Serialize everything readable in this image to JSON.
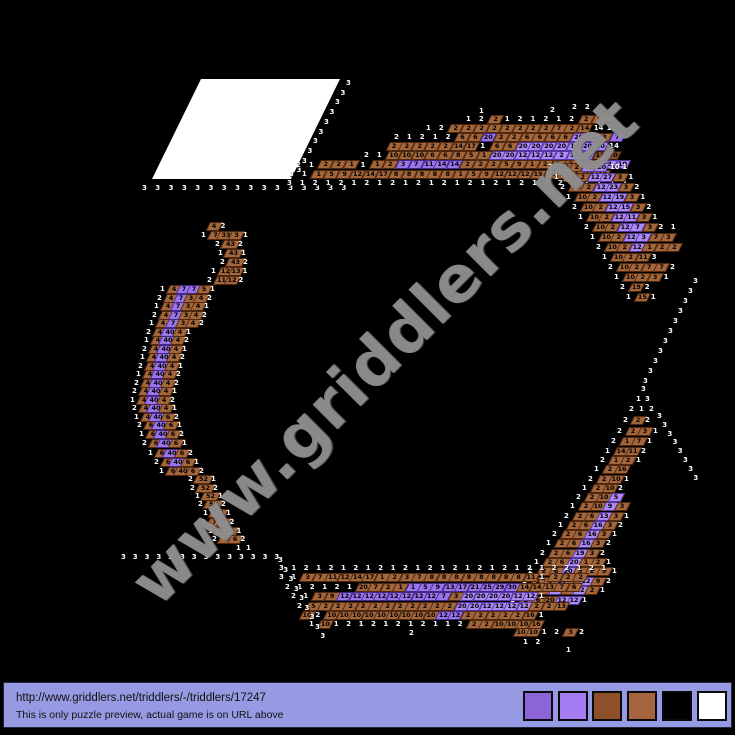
{
  "watermark": {
    "text": "www.griddlers.net",
    "color": "#949494"
  },
  "solved_region": {
    "x": 201,
    "y": 79,
    "w": 139,
    "h": 100
  },
  "footer": {
    "bg": "#969ae2",
    "url": "http://www.griddlers.net/triddlers/-/triddlers/17247",
    "note": "This is only puzzle preview, actual game is on URL above",
    "palette": [
      "#8b64d8",
      "#a57cf2",
      "#8e4f2b",
      "#a5663f",
      "#000000",
      "#ffffff"
    ],
    "palette_left": 519,
    "palette_step": 34.7
  },
  "puzzle": {
    "cell": {
      "w": 13,
      "h": 8.6
    },
    "colors": {
      "b": {
        "bg": "#a3663b",
        "bd": "#50280f"
      },
      "d": {
        "bg": "#8a4f28",
        "bd": "#3a1e08"
      },
      "p": {
        "bg": "#9a75ea",
        "bd": "#45278c"
      },
      "l": {
        "bg": "#ab89f4",
        "bd": "#5636a0"
      }
    },
    "wide_values": [
      "33",
      "40",
      "43",
      "52"
    ],
    "runs": [
      {
        "x": 146,
        "y": 188,
        "dx": 13.3,
        "cells": "w3 w3 w3 w3 w3 w3 w3 w3 w3 w3 w3 w3 w3 w3 w3 w3"
      },
      {
        "x": 350,
        "y": 83,
        "dx": -5.5,
        "dy": 9.7,
        "cells": "w3 w3 w3 w3 w3 w3 w3 w3 w3 w3"
      },
      {
        "x": 291,
        "y": 183,
        "dx": 12.9,
        "cells": "w3 w1 w2 w1 w2 w1 w2 w1 w2 w1 w2 w1 w2 w1 w2 w1 w2 w1 w2 w1 w2 w2 w1 w2 w1 w2 w1"
      },
      {
        "x": 293,
        "y": 174,
        "dx": 12.9,
        "cells": "w3 w1 b1 b5 b9 b12 b14 b17 b8 b8 b8 b8 b8 b1 b5 b9 b12 b12 b12 b15 b16 b16 b1 b10 b10"
      },
      {
        "x": 300,
        "y": 164.5,
        "dx": 12.9,
        "cells": "w2 w1 b2 b2 b1 w1 b1 b2 p3 p7 p11 p14 p14 b2 b2 b2 b5 b9 b1 b2 b2 b2 b10 b2 l2 l10"
      },
      {
        "x": 368,
        "y": 155,
        "dx": 12.9,
        "cells": "w2 w1 b10 b10 b10 b6 b6 b8 b5 b1 l20 l20 l12 l12 l12 l2 l12 l12 d12 d30"
      },
      {
        "x": 394,
        "y": 146,
        "dx": 12.9,
        "cells": "b2 b2 b2 b2 b2 b14 b17 w1 b6 b6 l20 l20 l20 l20 l12 l20 l20 w14"
      },
      {
        "x": 398,
        "y": 137,
        "dx": 12.9,
        "cells": "w2 w1 w2 w1 w2 b6 b6 p20 b2 b2 b6 b6 b6 b6 l20 l13 b3 p7"
      },
      {
        "x": 430,
        "y": 128,
        "dx": 12.9,
        "cells": "w1 w2 b2 b2 b2 b2 b2 b2 b2 b2 b7 b2 b14 w14 w1"
      },
      {
        "x": 470,
        "y": 119,
        "dx": 12.9,
        "cells": "w1 w2 b2 w1 w2 w1 w2 w1 w2 b2 b1 w2"
      },
      {
        "x": 483,
        "y": 111,
        "cells": "w1"
      },
      {
        "x": 554,
        "y": 110,
        "cells": "w2"
      },
      {
        "x": 576,
        "y": 107,
        "dx": 12.9,
        "cells": "w2 w2"
      },
      {
        "x": 552,
        "y": 167,
        "dx": 12.4,
        "cells": "w2 b10 b2 l12 l20 w10 w1"
      },
      {
        "x": 558,
        "y": 177,
        "dx": 12.4,
        "cells": "w1 b10 b2 l12 l27 b3 w1"
      },
      {
        "x": 564,
        "y": 187,
        "dx": 12.4,
        "cells": "w2 b10 b2 l12 l23 b3 w2"
      },
      {
        "x": 570,
        "y": 197,
        "dx": 12.4,
        "cells": "w1 b10 b2 l12 l19 b3 w1"
      },
      {
        "x": 576,
        "y": 207,
        "dx": 12.4,
        "cells": "w2 b10 b2 l12 l15 b3 w2"
      },
      {
        "x": 582,
        "y": 217,
        "dx": 12.4,
        "cells": "w1 b10 b2 l12 l11 b3 w1"
      },
      {
        "x": 588,
        "y": 227,
        "dx": 12.4,
        "cells": "w2 b10 b2 l12 l7 b3 w2 w1"
      },
      {
        "x": 594,
        "y": 237,
        "dx": 12.4,
        "cells": "w1 b10 b2 l12 l3 b7 b3"
      },
      {
        "x": 600,
        "y": 247,
        "dx": 12.4,
        "cells": "w2 b10 b2 l12 b1 b2 b2"
      },
      {
        "x": 606,
        "y": 257,
        "dx": 12.4,
        "cells": "w1 b10 b2 b11 w3"
      },
      {
        "x": 612,
        "y": 267,
        "dx": 12.4,
        "cells": "w2 b10 b2 b7 b7 w2"
      },
      {
        "x": 618,
        "y": 277,
        "dx": 12.4,
        "cells": "w1 b10 b2 b3 w1"
      },
      {
        "x": 624,
        "y": 287,
        "dx": 12.4,
        "cells": "w2 b19 w2"
      },
      {
        "x": 630,
        "y": 297,
        "dx": 12.4,
        "cells": "w1 b15 w1"
      },
      {
        "x": 697,
        "y": 281,
        "dx": -5,
        "dy": 10,
        "cells": "w3 w3 w3 w3 w3 w3 w3 w3 w3 w3 w3"
      },
      {
        "x": 661,
        "y": 416,
        "dx": 5.2,
        "dy": 8.8,
        "cells": "w3 w3 w3 w3 w3 w3 w3 w3"
      },
      {
        "x": 645,
        "y": 389,
        "cells": "w3"
      },
      {
        "x": 640,
        "y": 399,
        "dx": 9,
        "cells": "w1 w3"
      },
      {
        "x": 633,
        "y": 409,
        "dx": 10,
        "cells": "w2 w1 w2"
      },
      {
        "x": 627,
        "y": 420,
        "dx": 11,
        "cells": "w2 b2 w2"
      },
      {
        "x": 621,
        "y": 431,
        "dx": 12,
        "cells": "w2 b2 b3 w1"
      },
      {
        "x": 615,
        "y": 441,
        "dx": 12,
        "cells": "w2 b1 b7 w1"
      },
      {
        "x": 609,
        "y": 451,
        "dx": 12,
        "cells": "w1 b14 b11 w2"
      },
      {
        "x": 604,
        "y": 460,
        "dx": 12,
        "cells": "w2 b1 b2 w1"
      },
      {
        "x": 598,
        "y": 469,
        "dx": 12,
        "cells": "w1 b2 b16"
      },
      {
        "x": 592,
        "y": 479,
        "dx": 12,
        "cells": "w2 b2 b10 w1"
      },
      {
        "x": 586,
        "y": 488,
        "dx": 12,
        "cells": "w1 b2 b10 w2"
      },
      {
        "x": 580,
        "y": 497,
        "dx": 12,
        "cells": "w2 b2 b10 l5"
      },
      {
        "x": 574,
        "y": 506,
        "dx": 12,
        "cells": "w1 b2 b10 l9 b3"
      },
      {
        "x": 568,
        "y": 516,
        "dx": 12,
        "cells": "w2 b2 b6 l13 b3 w1"
      },
      {
        "x": 562,
        "y": 525,
        "dx": 12,
        "cells": "w1 b2 b6 l16 b3 w2"
      },
      {
        "x": 556,
        "y": 534,
        "dx": 12,
        "cells": "w2 b2 b6 l16 b3 w1"
      },
      {
        "x": 550,
        "y": 543,
        "dx": 12,
        "cells": "w1 b2 b6 l16 b3 w2"
      },
      {
        "x": 544,
        "y": 553,
        "dx": 12,
        "cells": "w2 b2 b6 l19 b3 w2"
      },
      {
        "x": 538,
        "y": 562,
        "dx": 12,
        "cells": "w1 b2 b6 l20 b1 b2 w1"
      },
      {
        "x": 532,
        "y": 571,
        "dx": 12,
        "cells": "w2 b2 b6 l20 b3 b2 b5 w1"
      },
      {
        "x": 526,
        "y": 581,
        "dx": 12,
        "cells": "w1 b2 b6 l20 b7 l12 b9 w2"
      },
      {
        "x": 520,
        "y": 590,
        "dx": 12,
        "cells": "w2 b2 b6 l20 b11 l12 b2 w1"
      },
      {
        "x": 514,
        "y": 600,
        "dx": 12,
        "cells": "w1 b2 b6 b20 l12 l12 w1"
      },
      {
        "x": 283,
        "y": 568,
        "dx": 12.4,
        "cells": "w3 w1 w2 w1 w2 w1 w2 w1 w2 w1 w2 w1 w2 w1 w2 w1 w2 w1 w2 w1 w2 w1 w2 w2 w1 w2 w1"
      },
      {
        "x": 283,
        "y": 577,
        "dx": 12.4,
        "cells": "w3 w1 b3 b7 b11 b12 b14 b17 b1 b2 b3 b7 b8 b8 b8 b8 b8 b8 b8 b8 b11 w1 b2 b2 b2"
      },
      {
        "x": 289,
        "y": 587,
        "dx": 12.4,
        "cells": "w2 w1 w2 w1 w2 w1 b20 b7 b2 b1 p1 p5 p9 p13 p17 p21 p25 p29 p30 b14 b14 b13 b7 b6"
      },
      {
        "x": 295,
        "y": 596,
        "dx": 12.4,
        "cells": "w2 w1 b3 b9 p12 p12 p12 p12 p12 p12 p12 p12 p7 b3 l20 l20 l20 l20 l12 l12 w1"
      },
      {
        "x": 301,
        "y": 606,
        "dx": 12.4,
        "cells": "w2 b5 b2 b2 b2 b2 b2 b2 b2 b2 b2 b2 b2 l20 l20 l12 l12 l12 l12 b2 b2 b13"
      },
      {
        "x": 307,
        "y": 615,
        "dx": 12.4,
        "cells": "b10 w2 b10 b10 b10 b10 b10 b10 b10 b10 b10 p12 p12 b2 b2 b2 b2 b2 b16 w1"
      },
      {
        "x": 313,
        "y": 624,
        "dx": 12.4,
        "cells": "w1 b10 w1 w2 w1 w2 w1 w2 w1 w2 w1 w1 w2 b2 b2 b10 b10 b10 b16"
      },
      {
        "x": 413,
        "y": 633,
        "cells": "w2"
      },
      {
        "x": 521,
        "y": 632,
        "dx": 12.4,
        "cells": "b10 b10 w1 w2 b3 w2"
      },
      {
        "x": 527,
        "y": 642,
        "dx": 12.4,
        "cells": "w1 w2"
      },
      {
        "x": 570,
        "y": 650,
        "cells": "w1"
      },
      {
        "x": 125,
        "y": 557,
        "dx": 11.8,
        "cells": "w3 w3 w3 w3 w3 w3 w3 w3 w3 w3 w3 w3 w3 w3"
      },
      {
        "x": 282,
        "y": 560,
        "dx": 5.3,
        "dy": 9.5,
        "cells": "w3 w3 w3 w3 w3 w3 w3 w3 w3"
      },
      {
        "x": 214,
        "y": 226,
        "dx": 10.5,
        "cells": "b4 w2"
      },
      {
        "x": 205,
        "y": 235,
        "dx": 10.5,
        "cells": "w1 b7 b33 b3 w1"
      },
      {
        "x": 219,
        "y": 244,
        "dx": 11.5,
        "cells": "w2 b43 w2"
      },
      {
        "x": 222,
        "y": 253,
        "dx": 11.5,
        "cells": "w1 b43 w1"
      },
      {
        "x": 224,
        "y": 262,
        "dx": 11.5,
        "cells": "w2 b43 w2"
      },
      {
        "x": 215,
        "y": 271,
        "dx": 10.5,
        "cells": "w1 b12 b13 w1"
      },
      {
        "x": 211,
        "y": 280,
        "dx": 10.5,
        "cells": "w2 b11 b12 w2"
      },
      {
        "x": 164,
        "y": 289,
        "dx": 10,
        "cells": "w1 b4 p7 p7 b5 w1"
      },
      {
        "x": 161,
        "y": 298,
        "dx": 10,
        "cells": "w2 b4 p7 b3 b4 w2"
      },
      {
        "x": 158,
        "y": 306,
        "dx": 10,
        "cells": "w1 b4 p7 b3 b4 w1"
      },
      {
        "x": 156,
        "y": 315,
        "dx": 10,
        "cells": "w2 b4 p7 b3 b4 w2"
      },
      {
        "x": 153,
        "y": 323,
        "dx": 10,
        "cells": "w1 b4 p7 b3 b4 w2"
      },
      {
        "x": 150,
        "y": 332,
        "dx": 10,
        "cells": "w2 b4 p40 b4 w1"
      },
      {
        "x": 148,
        "y": 340,
        "dx": 10,
        "cells": "w1 b4 p40 b4 w2"
      },
      {
        "x": 146,
        "y": 349,
        "dx": 10,
        "cells": "w2 b4 p40 b4 w1"
      },
      {
        "x": 144,
        "y": 357,
        "dx": 10,
        "cells": "w1 b4 p40 b4 w2"
      },
      {
        "x": 142,
        "y": 366,
        "dx": 10,
        "cells": "w2 b4 p40 b4 w1"
      },
      {
        "x": 140,
        "y": 374,
        "dx": 10,
        "cells": "w1 b4 p40 b4 w2"
      },
      {
        "x": 138,
        "y": 383,
        "dx": 10,
        "cells": "w2 b4 p40 b4 w2"
      },
      {
        "x": 136,
        "y": 391,
        "dx": 10,
        "cells": "w2 b4 p40 b4 w1"
      },
      {
        "x": 134,
        "y": 400,
        "dx": 10,
        "cells": "w1 b4 p40 b4 w2"
      },
      {
        "x": 136,
        "y": 408,
        "dx": 10,
        "cells": "w2 b4 p40 b4 w1"
      },
      {
        "x": 138,
        "y": 417,
        "dx": 10,
        "cells": "w1 b4 p40 b6 w2"
      },
      {
        "x": 141,
        "y": 425,
        "dx": 10,
        "cells": "w2 b6 p40 b6 w1"
      },
      {
        "x": 143,
        "y": 434,
        "dx": 10,
        "cells": "w1 b6 p40 b6 w2"
      },
      {
        "x": 146,
        "y": 443,
        "dx": 10,
        "cells": "w2 b6 p40 b6 w1"
      },
      {
        "x": 152,
        "y": 453,
        "dx": 10,
        "cells": "w1 b6 p40 b6 w2"
      },
      {
        "x": 158,
        "y": 462,
        "dx": 10,
        "cells": "w2 b6 p40 b6 w1"
      },
      {
        "x": 163,
        "y": 471,
        "dx": 10,
        "cells": "w1 b6 b40 b6 w2"
      },
      {
        "x": 192,
        "y": 479,
        "dx": 11.5,
        "cells": "w2 b52 w1"
      },
      {
        "x": 194,
        "y": 488,
        "dx": 11.5,
        "cells": "w2 b52 w2"
      },
      {
        "x": 199,
        "y": 496,
        "dx": 11.5,
        "cells": "w1 b52 w1"
      },
      {
        "x": 202,
        "y": 504,
        "dx": 11.5,
        "cells": "w2 b52 w2"
      },
      {
        "x": 207,
        "y": 513,
        "dx": 11.5,
        "cells": "w1 b52 w1"
      },
      {
        "x": 205,
        "y": 522,
        "dx": 9.5,
        "cells": "w2 b7 b6 w2"
      },
      {
        "x": 212,
        "y": 531,
        "dx": 9.5,
        "cells": "w1 b6 b6 w1"
      },
      {
        "x": 216,
        "y": 539,
        "dx": 9.5,
        "cells": "w2 b6 b6 w2"
      },
      {
        "x": 240,
        "y": 548,
        "dx": 10,
        "cells": "w1 w1"
      }
    ]
  }
}
